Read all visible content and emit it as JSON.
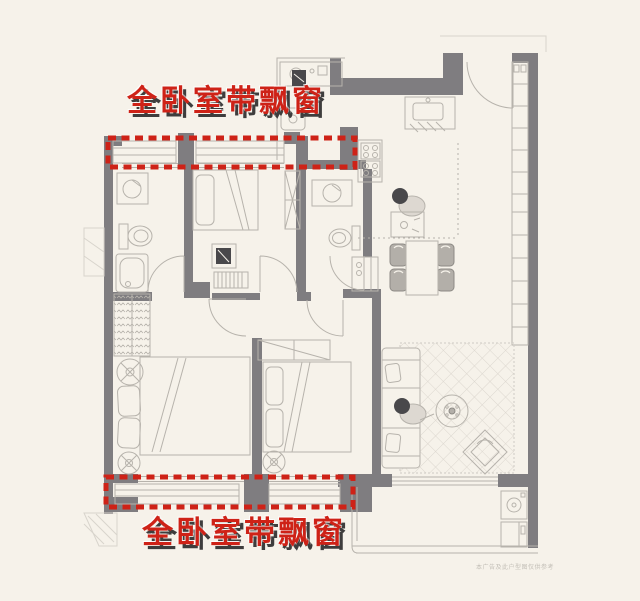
{
  "canvas": {
    "width": 640,
    "height": 601
  },
  "colors": {
    "background": "#f6f2ea",
    "wall_gray": "#7f7d80",
    "line_gray": "#b7b3ac",
    "line_light": "#d8d4cc",
    "dark_fill": "#49484b",
    "highlight_red": "#ce2217",
    "shadow_dark": "#3e3d3d",
    "disclaimer_gray": "#c3bfb7"
  },
  "annotations": {
    "top_label": "全卧室带飘窗",
    "bottom_label": "全卧室带飘窗",
    "disclaimer": "本广告及此户型图仅供参考"
  },
  "floor_plan": {
    "type": "residential-floor-plan",
    "highlighted_feature": "bay-windows-on-all-bedrooms",
    "highlight_style": "red-dashed-rectangles",
    "rooms": [
      "bathroom-1",
      "bedroom-2",
      "bathroom-2",
      "kitchen",
      "entry",
      "dining",
      "living-room",
      "master-bedroom",
      "bedroom-3",
      "balcony",
      "storage-wall",
      "utility-top-room"
    ]
  }
}
